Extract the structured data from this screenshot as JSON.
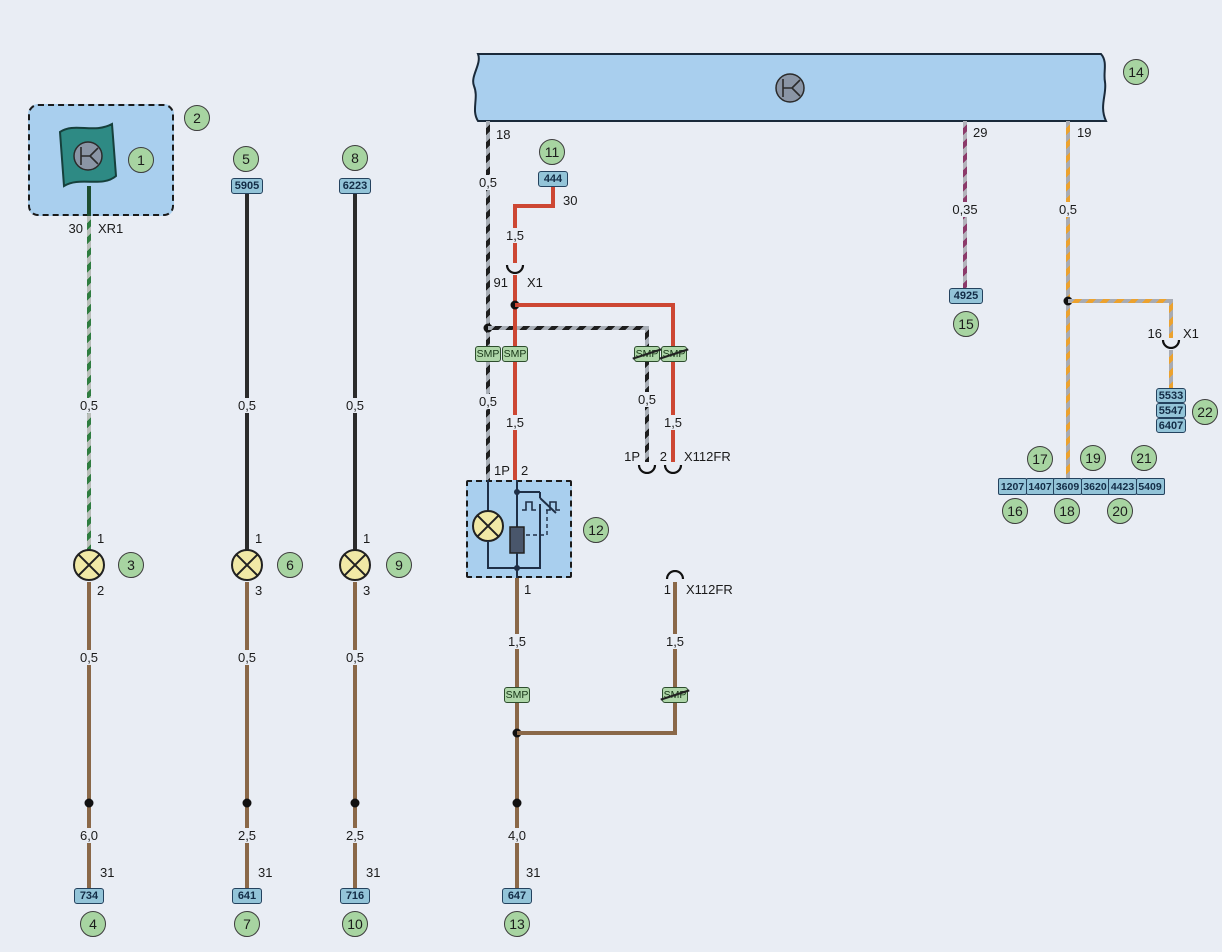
{
  "colors": {
    "paper": "#e9edf4",
    "bus_fill": "#a9cfee",
    "wire_red": "#cd4733",
    "wire_brown": "#8a6848",
    "wire_black": "#2b2b2b",
    "stripe_green": "#2f7d40",
    "stripe_black": "#1e1e1e",
    "stripe_purple": "#8c3a6a",
    "stripe_orange": "#eca22e",
    "callout_fill": "#a7d4a1",
    "pinbox_fill": "#93c4d8",
    "smp_fill": "#aed6a8",
    "lamp_fill": "#f1e9a6",
    "component_teal": "#2e8a84"
  },
  "callouts": {
    "n1": "1",
    "n2": "2",
    "n3": "3",
    "n4": "4",
    "n5": "5",
    "n6": "6",
    "n7": "7",
    "n8": "8",
    "n9": "9",
    "n10": "10",
    "n11": "11",
    "n12": "12",
    "n13": "13",
    "n14": "14",
    "n15": "15",
    "n16": "16",
    "n17": "17",
    "n18": "18",
    "n19": "19",
    "n20": "20",
    "n21": "21",
    "n22": "22"
  },
  "pin_boxes": {
    "b444": "444",
    "b5905": "5905",
    "b6223": "6223",
    "b734": "734",
    "b641": "641",
    "b716": "716",
    "b647": "647",
    "b4925": "4925",
    "b5533": "5533",
    "b5547": "5547",
    "b6407": "6407"
  },
  "strip": [
    "1207",
    "1407",
    "3609",
    "3620",
    "4423",
    "5409"
  ],
  "smp_label": "SMP",
  "labels": {
    "a_30": "30",
    "a_xr1": "XR1",
    "a_05": "0,5",
    "a_p1": "1",
    "a_p2": "2",
    "a_05b": "0,5",
    "a_60": "6,0",
    "a_31": "31",
    "b_05": "0,5",
    "b_p1": "1",
    "b_p3": "3",
    "b_05b": "0,5",
    "b_25": "2,5",
    "b_31": "31",
    "c_05": "0,5",
    "c_p1": "1",
    "c_p3": "3",
    "c_05b": "0,5",
    "c_25": "2,5",
    "c_31": "31",
    "d_18": "18",
    "d_05": "0,5",
    "d_05b": "0,5",
    "d_p1p": "1P",
    "r_30": "30",
    "r_15": "1,5",
    "r_91": "91",
    "r_x1": "X1",
    "r_15b": "1,5",
    "r_p2": "2",
    "e_05": "0,5",
    "e_p1p": "1P",
    "e_15": "1,5",
    "e_p2": "2",
    "e_x112": "X112FR",
    "f_p1": "1",
    "f_15": "1,5",
    "f_40": "4,0",
    "f_31": "31",
    "g_p1": "1",
    "g_x112": "X112FR",
    "g_15": "1,5",
    "h_29": "29",
    "h_035": "0,35",
    "i_19": "19",
    "i_05": "0,5",
    "i_16": "16",
    "i_x1": "X1"
  }
}
